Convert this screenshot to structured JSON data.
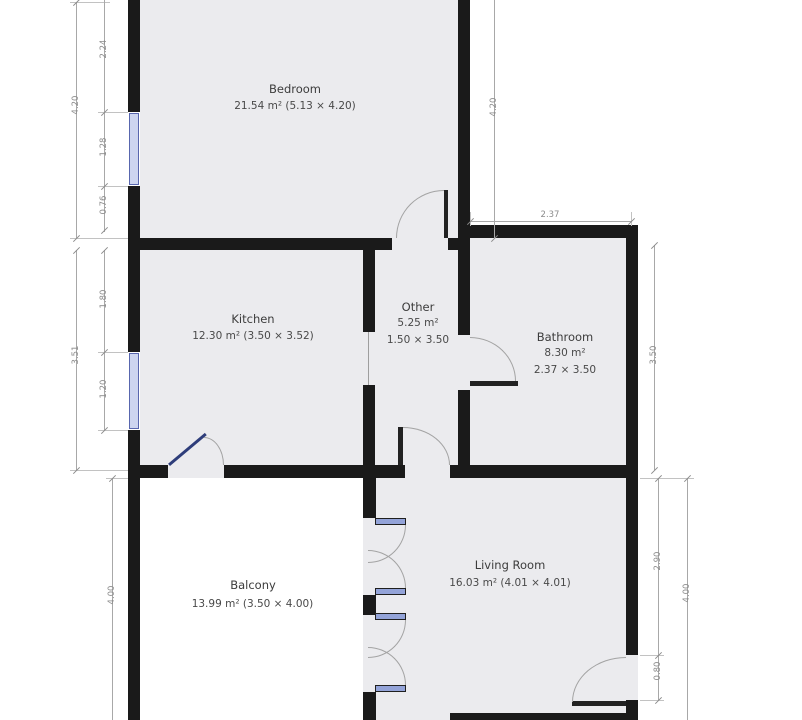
{
  "rooms": {
    "bedroom": {
      "name": "Bedroom",
      "area": "21.54 m² (5.13 × 4.20)"
    },
    "kitchen": {
      "name": "Kitchen",
      "area": "12.30 m² (3.50 × 3.52)"
    },
    "other": {
      "name": "Other",
      "area": "5.25 m²",
      "dims": "1.50 × 3.50"
    },
    "bathroom": {
      "name": "Bathroom",
      "area": "8.30 m²",
      "dims": "2.37 × 3.50"
    },
    "balcony": {
      "name": "Balcony",
      "area": "13.99 m² (3.50 × 4.00)"
    },
    "living_room": {
      "name": "Living Room",
      "area": "16.03 m² (4.01 × 4.01)"
    }
  },
  "dimensions": {
    "bedroom_left_total": "4.20",
    "bedroom_left_top": "2.24",
    "bedroom_left_window": "1.28",
    "bedroom_left_bottom": "0.76",
    "kitchen_left_total": "3.51",
    "kitchen_left_top": "1.80",
    "kitchen_left_window": "1.20",
    "balcony_left": "4.00",
    "bedroom_right": "4.20",
    "bathroom_top": "2.37",
    "bathroom_right": "3.50",
    "living_right_upper": "2.90",
    "living_right_door": "0.80",
    "living_right_total": "4.00"
  },
  "colors": {
    "wall": "#1a1a1a",
    "room_fill": "#ebebee",
    "window_blue": "#93a3d8",
    "dimension_gray": "#8c8c8c"
  }
}
